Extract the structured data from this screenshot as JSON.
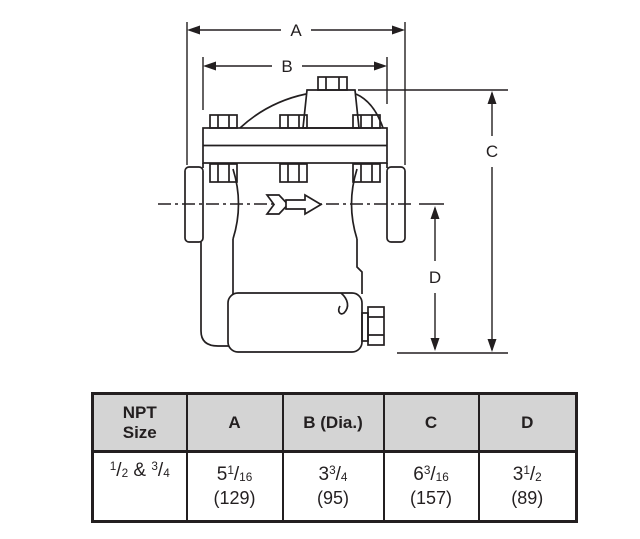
{
  "diagram": {
    "labels": {
      "a": "A",
      "b": "B",
      "c": "C",
      "d": "D"
    },
    "flow_arrow": "hollow-right-arrow",
    "line_color": "#231f20"
  },
  "table": {
    "headers": {
      "npt_size": "NPT\nSize",
      "a": "A",
      "b": "B (Dia.)",
      "c": "C",
      "d": "D"
    },
    "row": {
      "npt_size": {
        "f1_num": "1",
        "f1_den": "2",
        "joiner": " & ",
        "f2_num": "3",
        "f2_den": "4"
      },
      "a": {
        "whole": "5",
        "num": "1",
        "den": "16",
        "metric": "(129)"
      },
      "b": {
        "whole": "3",
        "num": "3",
        "den": "4",
        "metric": "(95)"
      },
      "c": {
        "whole": "6",
        "num": "3",
        "den": "16",
        "metric": "(157)"
      },
      "d": {
        "whole": "3",
        "num": "1",
        "den": "2",
        "metric": "(89)"
      }
    },
    "misc": {
      "slash": "/"
    }
  },
  "colors": {
    "line": "#231f20",
    "header_bg": "#d4d4d4",
    "background": "#ffffff"
  }
}
